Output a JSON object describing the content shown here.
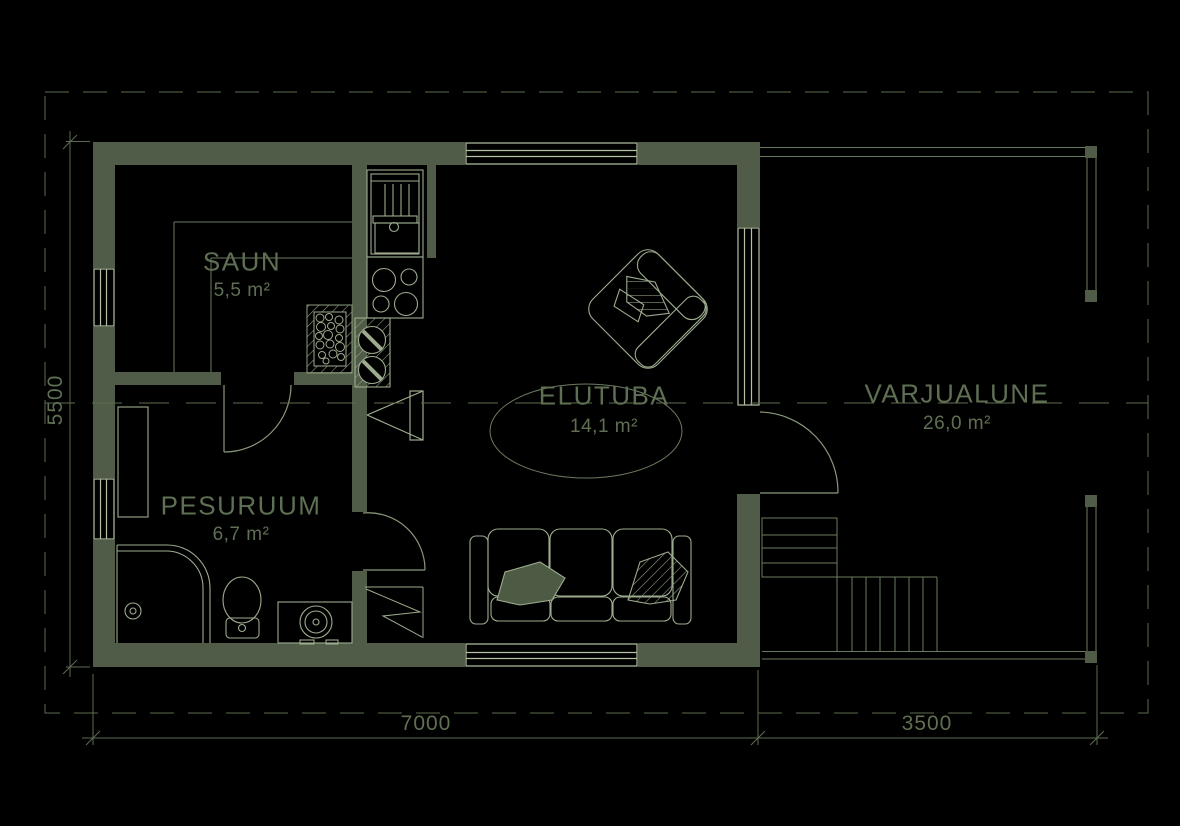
{
  "drawing": {
    "type": "floor-plan",
    "rooms": [
      {
        "id": "saun",
        "name": "SAUN",
        "area": "5,5 m²"
      },
      {
        "id": "pesuruum",
        "name": "PESURUUM",
        "area": "6,7 m²"
      },
      {
        "id": "elutuba",
        "name": "ELUTUBA",
        "area": "14,1 m²"
      },
      {
        "id": "varjualune",
        "name": "VARJUALUNE",
        "area": "26,0 m²"
      }
    ],
    "dimensions": {
      "left_height": "5500",
      "bottom_left_width": "7000",
      "bottom_right_width": "3500"
    },
    "colors": {
      "background": "#000000",
      "wall_fill": "#505c47",
      "window_line": "#b3c0a4",
      "fixture_line": "#9dac8f",
      "door_line": "#8a997c",
      "secondary_line": "#6c7b60",
      "dimension_line": "#5c6c50",
      "text": "#5f6f53"
    }
  }
}
